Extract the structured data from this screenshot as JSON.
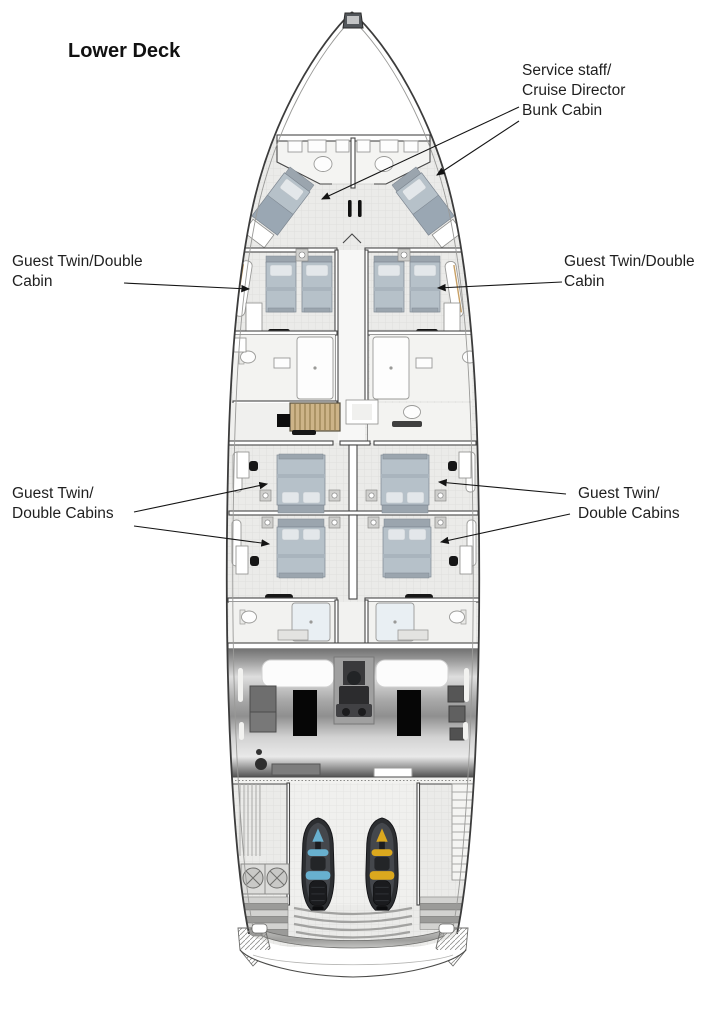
{
  "title": "Lower Deck",
  "labels": {
    "bunk_cabin": {
      "line1": "Service staff/",
      "line2": "Cruise Director",
      "line3": "Bunk Cabin"
    },
    "guest_twin_left": {
      "line1": "Guest Twin/Double",
      "line2": "Cabin"
    },
    "guest_twin_right": {
      "line1": "Guest Twin/Double",
      "line2": "Cabin"
    },
    "guest_twins_mid_left": {
      "line1": "Guest Twin/",
      "line2": "Double Cabins"
    },
    "guest_twins_mid_right": {
      "line1": "Guest Twin/",
      "line2": "Double Cabins"
    }
  },
  "colors": {
    "bed": "#b6c1c9",
    "pillow": "#e3e7ea",
    "stairs_wood": "#cdb488",
    "jetski_body": "#2c2e31",
    "jetski_blue_accent": "#68b0cf",
    "jetski_yellow_accent": "#dba81e",
    "hull_outline": "#3c3c3c",
    "label_text": "#1f1f1f"
  },
  "icons": {
    "staircase": "staircase-icon",
    "jet_ski": "jet-ski-top-view-icon",
    "engine": "engine-block-icon",
    "toilet": "toilet-icon",
    "shower": "shower-icon",
    "arrow": "annotation-arrow-icon"
  }
}
